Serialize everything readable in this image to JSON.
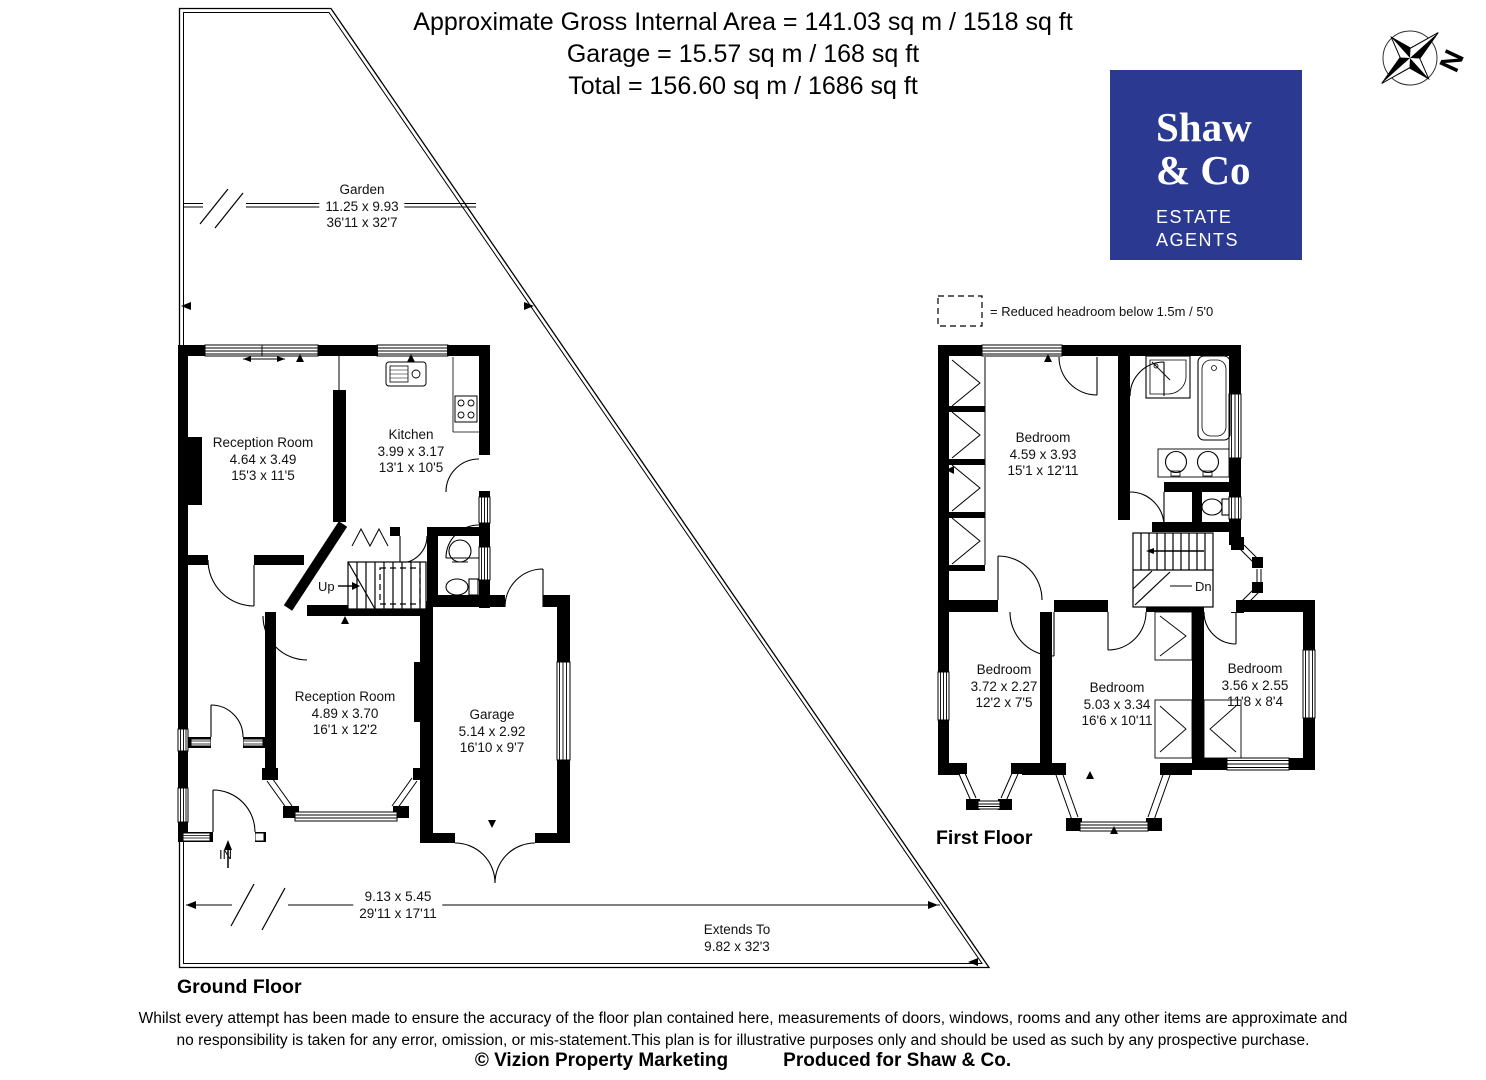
{
  "header": {
    "line1": "Approximate Gross Internal Area = 141.03 sq m / 1518 sq ft",
    "line2": "Garage = 15.57 sq m / 168 sq ft",
    "line3": "Total = 156.60 sq m / 1686 sq ft"
  },
  "logo": {
    "name_line1": "Shaw",
    "name_line2": "& Co",
    "sub_line1": "ESTATE",
    "sub_line2": "AGENTS",
    "bg_color": "#2b3990"
  },
  "compass": {
    "label": "N"
  },
  "legend": {
    "text": "= Reduced headroom below 1.5m / 5'0"
  },
  "ground_floor": {
    "title": "Ground Floor",
    "garden": {
      "name": "Garden",
      "metric": "11.25 x 9.93",
      "imperial": "36'11 x 32'7"
    },
    "rooms": [
      {
        "name": "Reception Room",
        "metric": "4.64 x 3.49",
        "imperial": "15'3 x 11'5"
      },
      {
        "name": "Kitchen",
        "metric": "3.99 x 3.17",
        "imperial": "13'1 x 10'5"
      },
      {
        "name": "Reception Room",
        "metric": "4.89 x 3.70",
        "imperial": "16'1 x 12'2"
      },
      {
        "name": "Garage",
        "metric": "5.14 x 2.92",
        "imperial": "16'10 x 9'7"
      }
    ],
    "overall": {
      "metric": "9.13 x 5.45",
      "imperial": "29'11 x 17'11"
    },
    "extends_to": {
      "line1": "Extends To",
      "line2": "9.82 x 32'3"
    },
    "stairs_label": "Up",
    "entrance_label": "IN"
  },
  "first_floor": {
    "title": "First Floor",
    "rooms": [
      {
        "name": "Bedroom",
        "metric": "4.59 x 3.93",
        "imperial": "15'1 x 12'11"
      },
      {
        "name": "Bedroom",
        "metric": "3.72 x 2.27",
        "imperial": "12'2 x 7'5"
      },
      {
        "name": "Bedroom",
        "metric": "5.03 x 3.34",
        "imperial": "16'6 x 10'11"
      },
      {
        "name": "Bedroom",
        "metric": "3.56 x 2.55",
        "imperial": "11'8 x 8'4"
      }
    ],
    "stairs_label": "Dn"
  },
  "footer": {
    "disclaimer_line1": "Whilst every attempt has been made to ensure the accuracy of the floor plan contained here, measurements of doors, windows, rooms and any other items are approximate and",
    "disclaimer_line2": "no responsibility is taken for any error, omission, or mis-statement.This plan is for illustrative purposes only and should be used as such by any prospective purchase.",
    "copyright": "© Vizion Property Marketing",
    "produced": "Produced for Shaw & Co."
  }
}
